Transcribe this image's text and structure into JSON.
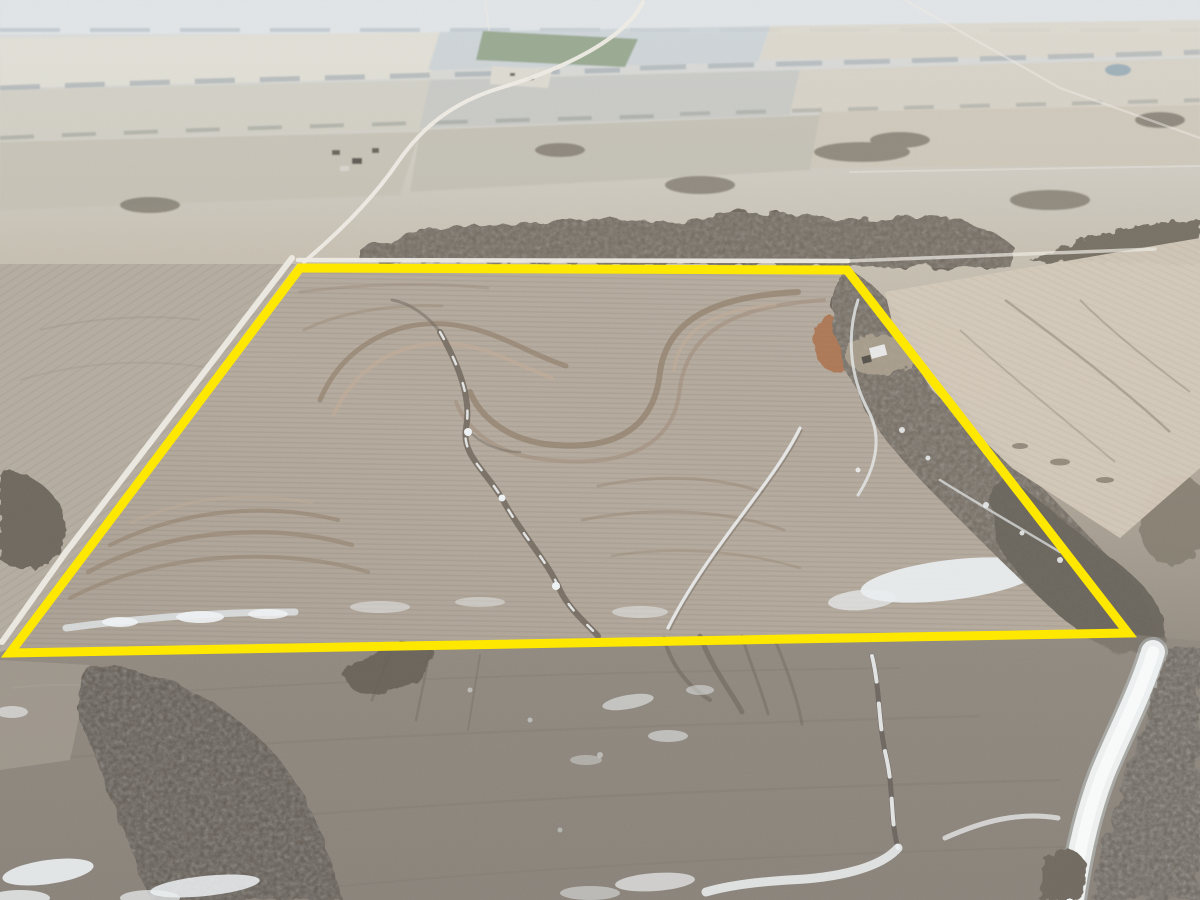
{
  "scene": {
    "type": "aerial-drone-photo",
    "subject": "Winter farmland aerial photo with a highlighted land parcel boundary",
    "season": "winter",
    "text_visible": "none"
  },
  "boundary": {
    "shape": "quadrilateral",
    "points": "300,268 847,270 1128,633 10,653",
    "color": "#ffe800",
    "stroke_width": 9
  },
  "palette": {
    "haze_top": "#e2e6e8",
    "distant_cream": "#e3e0d6",
    "distant_blue": "#ccd3d7",
    "mid_field": "#c7c2b5",
    "parcel_field": "#b6ab9e",
    "terrace_brown": "#8d7964",
    "right_field": "#d5cabb",
    "foreground_field": "#8d857b",
    "trees_dark": "#6f685d",
    "trees_deep": "#5e5850",
    "snow_white": "#f0f3f4",
    "road_white": "#f0ede6",
    "green_field": "#93a489",
    "orange_patch": "#ad7049",
    "pond_blue": "#9fb1ba"
  },
  "features": [
    {
      "name": "parcel-boundary-overlay",
      "kind": "highlight"
    },
    {
      "name": "gravel-road-west",
      "kind": "road"
    },
    {
      "name": "gravel-road-north",
      "kind": "road"
    },
    {
      "name": "diagonal-road-distant",
      "kind": "road"
    },
    {
      "name": "green-winter-field",
      "kind": "field"
    },
    {
      "name": "farm-pond",
      "kind": "water"
    },
    {
      "name": "farmstead-building",
      "kind": "building"
    },
    {
      "name": "terraced-cropland",
      "kind": "field"
    },
    {
      "name": "creek-tree-corridor",
      "kind": "trees"
    },
    {
      "name": "snow-drifts",
      "kind": "snow"
    },
    {
      "name": "drainage-waterway",
      "kind": "water"
    }
  ]
}
